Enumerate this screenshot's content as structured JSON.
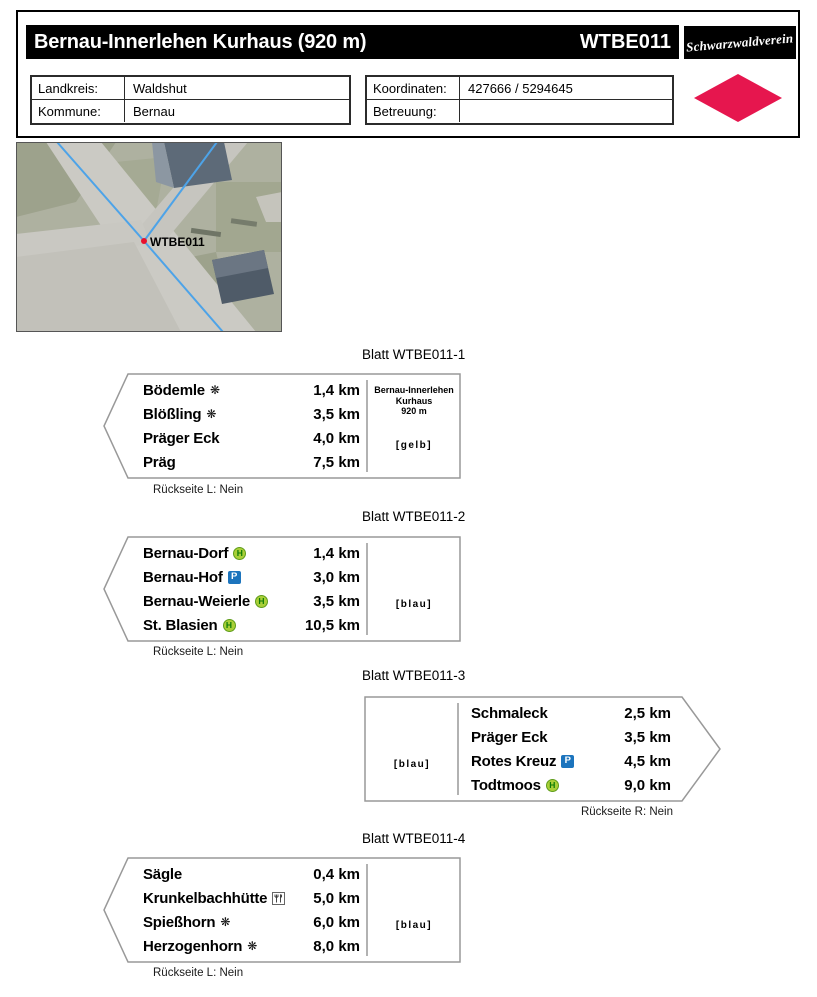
{
  "header": {
    "title": "Bernau-Innerlehen Kurhaus (920 m)",
    "code": "WTBE011",
    "logo_text": "Schwarzwaldverein",
    "info_left": {
      "rows": [
        {
          "label": "Landkreis:",
          "value": "Waldshut"
        },
        {
          "label": "Kommune:",
          "value": "Bernau"
        }
      ]
    },
    "info_right": {
      "rows": [
        {
          "label": "Koordinaten:",
          "value": "427666 / 5294645"
        },
        {
          "label": "Betreuung:",
          "value": ""
        }
      ]
    }
  },
  "map": {
    "marker_label": "WTBE011"
  },
  "signs": [
    {
      "heading": "Blatt WTBE011-1",
      "direction": "left",
      "rows": [
        {
          "name": "Bödemle",
          "icon": "snowflake",
          "dist": "1,4 km"
        },
        {
          "name": "Blößling",
          "icon": "snowflake",
          "dist": "3,5 km"
        },
        {
          "name": "Präger Eck",
          "icon": null,
          "dist": "4,0 km"
        },
        {
          "name": "Präg",
          "icon": null,
          "dist": "7,5 km"
        }
      ],
      "panel": {
        "title_lines": [
          "Bernau-Innerlehen",
          "Kurhaus",
          "920 m"
        ],
        "color_tag": "[gelb]"
      },
      "footer": "Rückseite L: Nein"
    },
    {
      "heading": "Blatt WTBE011-2",
      "direction": "left",
      "rows": [
        {
          "name": "Bernau-Dorf",
          "icon": "bus-stop",
          "dist": "1,4 km"
        },
        {
          "name": "Bernau-Hof",
          "icon": "parking",
          "dist": "3,0 km"
        },
        {
          "name": "Bernau-Weierle",
          "icon": "bus-stop",
          "dist": "3,5 km"
        },
        {
          "name": "St. Blasien",
          "icon": "bus-stop",
          "dist": "10,5 km"
        }
      ],
      "panel": {
        "color_tag": "[blau]"
      },
      "footer": "Rückseite L: Nein"
    },
    {
      "heading": "Blatt WTBE011-3",
      "direction": "right",
      "rows": [
        {
          "name": "Schmaleck",
          "icon": null,
          "dist": "2,5 km"
        },
        {
          "name": "Präger Eck",
          "icon": null,
          "dist": "3,5 km"
        },
        {
          "name": "Rotes Kreuz",
          "icon": "parking",
          "dist": "4,5 km"
        },
        {
          "name": "Todtmoos",
          "icon": "bus-stop",
          "dist": "9,0 km"
        }
      ],
      "panel": {
        "color_tag": "[blau]"
      },
      "footer": "Rückseite R: Nein"
    },
    {
      "heading": "Blatt WTBE011-4",
      "direction": "left",
      "rows": [
        {
          "name": "Sägle",
          "icon": null,
          "dist": "0,4 km"
        },
        {
          "name": "Krunkelbachhütte",
          "icon": "restaurant",
          "dist": "5,0 km"
        },
        {
          "name": "Spießhorn",
          "icon": "snowflake",
          "dist": "6,0 km"
        },
        {
          "name": "Herzogenhorn",
          "icon": "snowflake",
          "dist": "8,0 km"
        }
      ],
      "panel": {
        "color_tag": "[blau]"
      },
      "footer": "Rückseite L: Nein"
    }
  ],
  "icons": {
    "snowflake": "❋",
    "bus_stop_letter": "H",
    "parking_letter": "P"
  },
  "colors": {
    "accent_red": "#e6164e",
    "bus_stop_green": "#a9cf38",
    "parking_blue": "#1c74bd",
    "sign_border": "#999999"
  }
}
